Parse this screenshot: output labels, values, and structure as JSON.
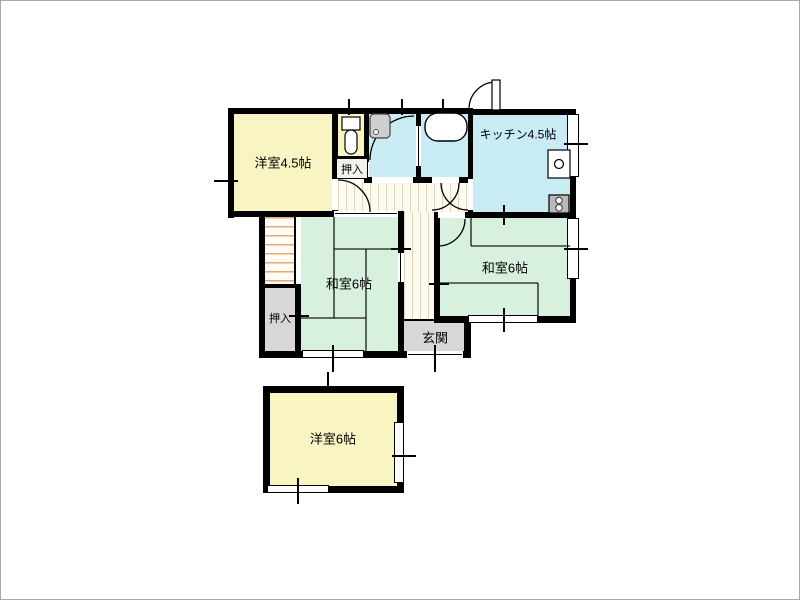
{
  "rooms": [
    {
      "name": "western-room-4-5",
      "label": "洋室4.5帖"
    },
    {
      "name": "kitchen",
      "label": "キッチン4.5帖"
    },
    {
      "name": "japanese-room-6-left",
      "label": "和室6帖"
    },
    {
      "name": "japanese-room-6-right",
      "label": "和室6帖"
    },
    {
      "name": "entrance",
      "label": "玄関"
    },
    {
      "name": "western-room-6",
      "label": "洋室6帖"
    },
    {
      "name": "closet-upper",
      "label": "押入"
    },
    {
      "name": "closet-left",
      "label": "押入"
    }
  ],
  "colors": {
    "wall": "#000000",
    "western_room_fill": "#f8f5c3",
    "kitchen_bath_fill": "#c9ecf4",
    "japanese_room_fill": "#d8f0de",
    "closet_entrance_fill": "#d7d7d7",
    "hallway_stripe": "#e2d5ba",
    "stair_stripe": "#e2a97c"
  },
  "fixtures": [
    {
      "name": "toilet-icon"
    },
    {
      "name": "washbasin-icon"
    },
    {
      "name": "bathtub-icon"
    },
    {
      "name": "kitchen-sink-icon"
    },
    {
      "name": "stove-icon"
    },
    {
      "name": "staircase"
    }
  ]
}
